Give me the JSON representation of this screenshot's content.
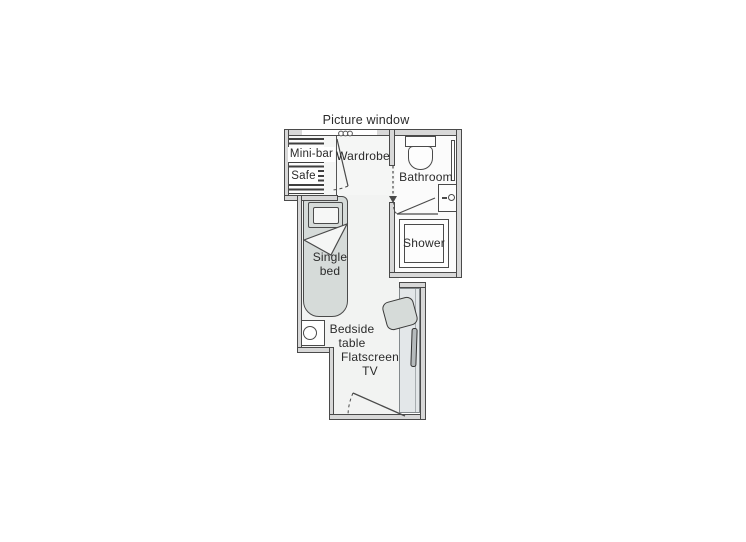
{
  "floorplan": {
    "type": "cabin-floor-plan",
    "labels": {
      "picture_window": "Picture window",
      "mini_bar": "Mini-bar",
      "safe": "Safe",
      "wardrobe": "Wardrobe",
      "bathroom": "Bathroom",
      "shower": "Shower",
      "single_bed": "Single\nbed",
      "bedside_table": "Bedside\ntable",
      "flatscreen_tv": "Flatscreen\nTV"
    },
    "colors": {
      "wall_fill": "#d8d8d8",
      "wall_line": "#4a4a4a",
      "floor_top": "#f5f6f5",
      "floor_main": "#f2f3f2",
      "floor_bath": "#fbfbfb",
      "bed_fill": "#d6dbd9",
      "panel_fill": "#e3e7e9",
      "tv_fill": "#b5babc",
      "text": "#2b2b2b",
      "page_bg": "#ffffff"
    }
  }
}
